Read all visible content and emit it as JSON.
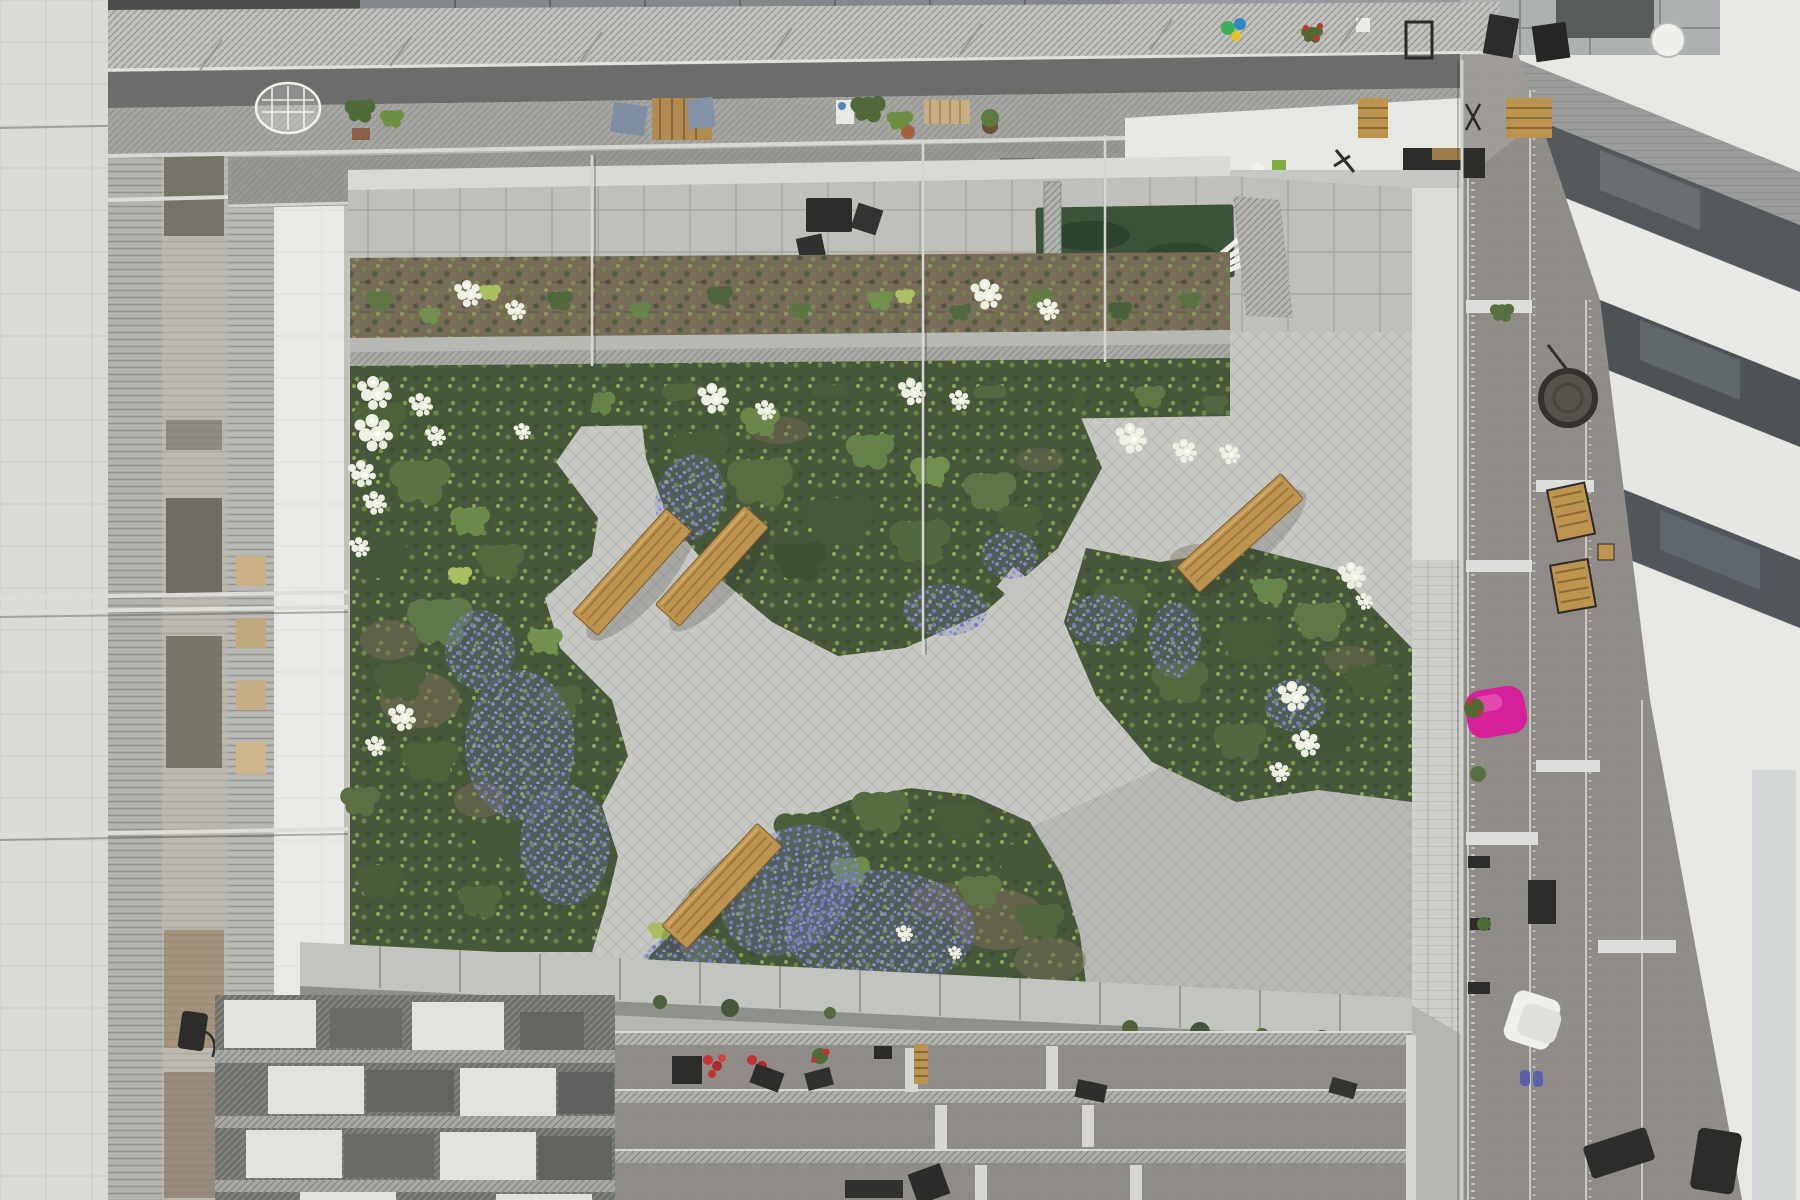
{
  "scene": {
    "title": "Courtyard garden from above",
    "description": "Top-down photograph looking into a rectangular residential courtyard: a wild perennial garden with white hydrangeas and purple flower drifts, crossed by light concrete paver paths with four wooden benches, surrounded by galvanized-steel gallery walkways, balconies with plants and furniture, a small artificial lawn and concrete patio slabs.",
    "view": "top-down",
    "setting": "residential courtyard"
  },
  "palette": {
    "paving": "#c7c8c3",
    "patio_slab": "#bfc0bb",
    "white_wall": "#e7e7e3",
    "concrete_wall": "#c2c4c0",
    "grate": "#c0c1bd",
    "balcony_tile": "#8f8c87",
    "window_dark": "#565b5e",
    "lawn": "#3c5339",
    "foliage_dark": "#47573a",
    "foliage_mid": "#5d7044",
    "foliage_bright": "#7d9c4a",
    "foliage_yellow": "#a9bf62",
    "soil": "#786d58",
    "flower_white": "#edefe3",
    "flower_purple": "#8186c0",
    "flower_red": "#c23434",
    "bench_wood": "#bd9350",
    "furniture_dark": "#2c2c2a",
    "bag_pink": "#d6219a"
  },
  "courtyard": {
    "path_material": "light concrete pavers laid diagonally",
    "garden_beds": 4,
    "benches": {
      "count": 4,
      "material": "wood slats"
    },
    "lawn": {
      "type": "artificial turf patch"
    },
    "flowers": {
      "white": "hydrangea clusters",
      "purple": "low flowering groundcover drifts",
      "red": "balcony flower boxes"
    },
    "patio": "large concrete slabs with dark outdoor furniture"
  },
  "buildings": {
    "left": "stacked gallery walkways of metal grating with windows and potted plants",
    "top": "gallery walkways with tables, chairs, plant pots and a white wire chair",
    "right": "tiled private balconies with wooden deck chairs, a hanging wicker chair and a pink bean bag",
    "bottom": "balconies with red flower boxes, dark furniture and a concrete retaining wall"
  }
}
